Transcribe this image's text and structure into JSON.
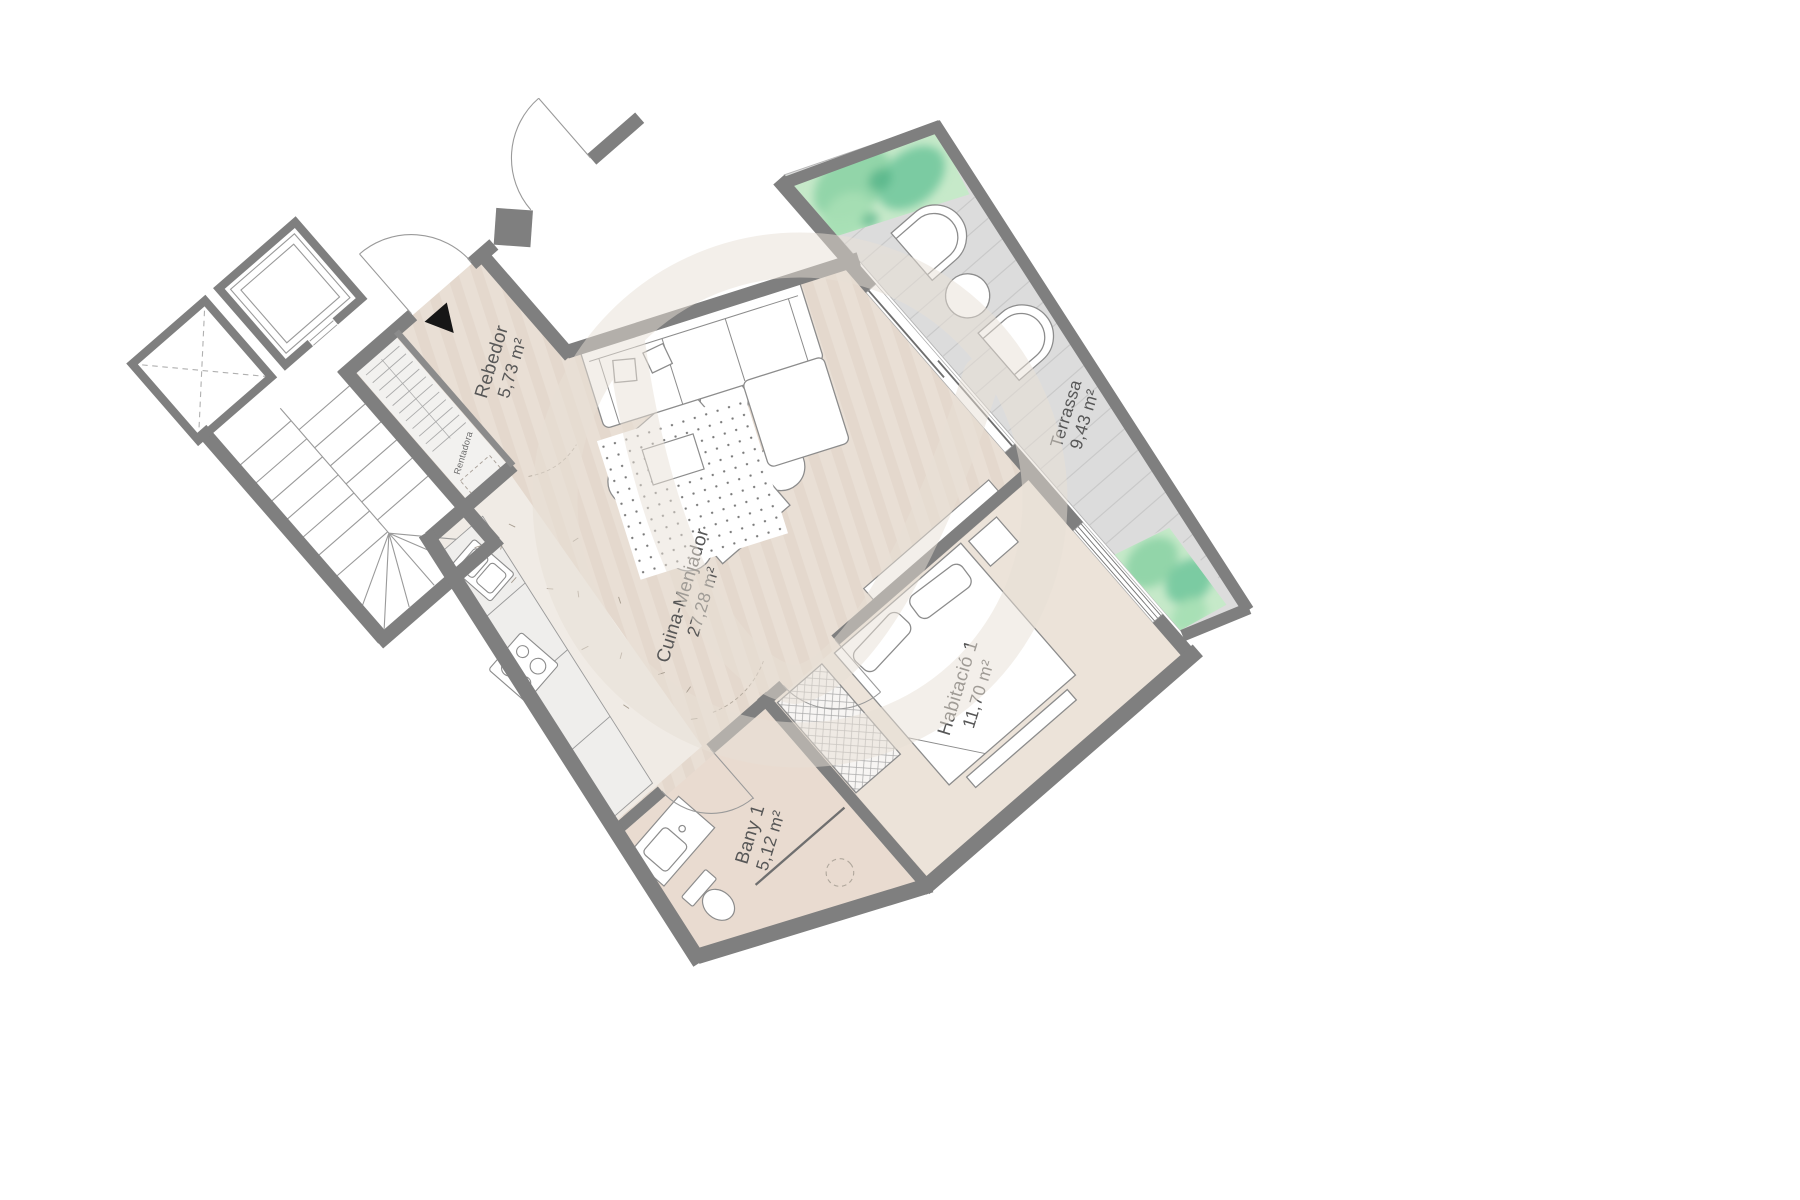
{
  "plan": {
    "rooms": [
      {
        "id": "rebedor",
        "name": "Rebedor",
        "area": "5,73 m²"
      },
      {
        "id": "cuina-menjador",
        "name": "Cuina-Menjador",
        "area": "27,28 m²"
      },
      {
        "id": "bany-1",
        "name": "Bany 1",
        "area": "5,12 m²"
      },
      {
        "id": "habitacio-1",
        "name": "Habitació 1",
        "area": "11,70 m²"
      },
      {
        "id": "terrassa",
        "name": "Terrassa",
        "area": "9,43 m²"
      }
    ],
    "appliance_label": "Rentadora",
    "colors": {
      "wall": "#7f7f7f",
      "floor_beige": "#e9dfd5",
      "bedroom_floor": "#ece3d9",
      "bath_floor": "#e9dbd0",
      "kitchen_floor": "#f0ebe5",
      "terrace_deck": "#dcdcdc",
      "terrace_slat": "#c9c9c9",
      "planter_green": "#8fd4a8",
      "planter_green_dark": "#66bb94",
      "furniture_stroke": "#8c8c8c",
      "label_text": "#575757",
      "watermark": "#e8e0d6",
      "entrance_marker": "#161616"
    }
  }
}
